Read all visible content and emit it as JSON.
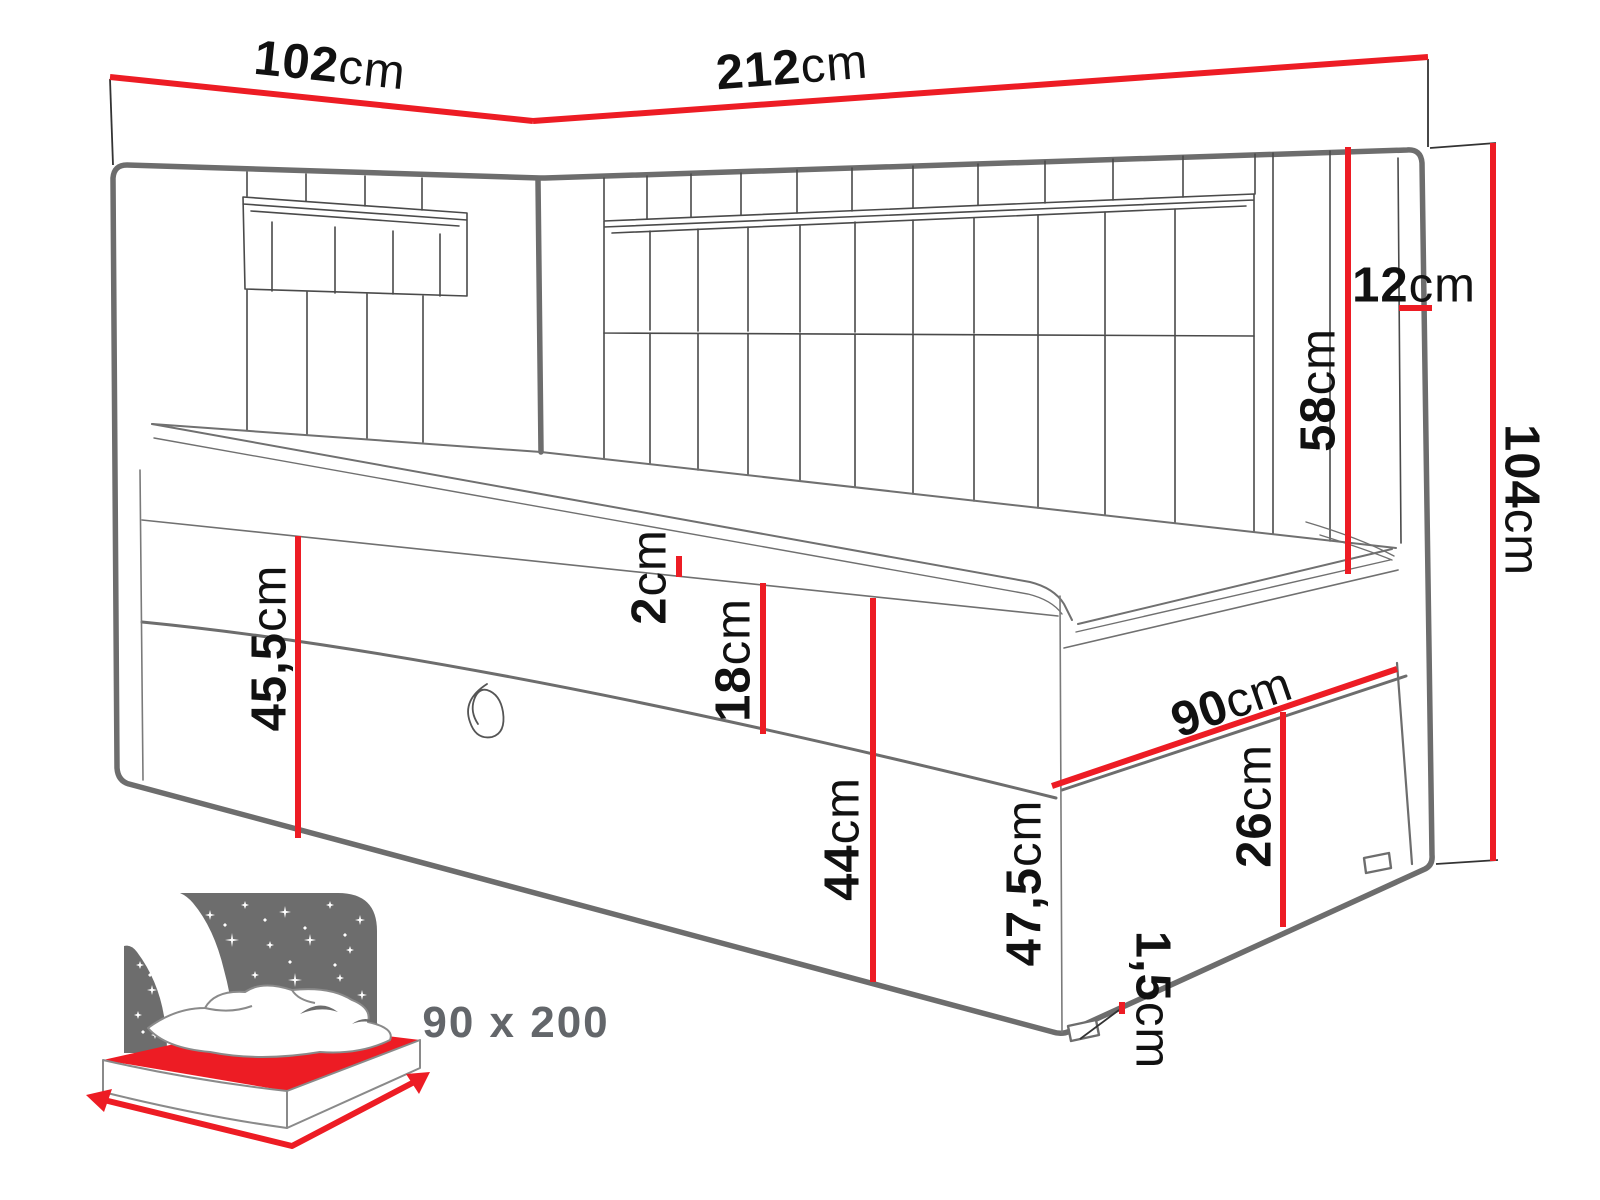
{
  "diagram": {
    "kind": "bed-dimension-drawing",
    "labels": {
      "head_width": {
        "value": "102",
        "unit": "cm"
      },
      "back_width": {
        "value": "212",
        "unit": "cm"
      },
      "total_height": {
        "value": "104",
        "unit": "cm"
      },
      "headboard_panel_height": {
        "value": "58",
        "unit": "cm"
      },
      "headboard_depth": {
        "value": "12",
        "unit": "cm"
      },
      "left_front_height": {
        "value": "45,5",
        "unit": "cm"
      },
      "topper_thickness": {
        "value": "2",
        "unit": "cm"
      },
      "upper_box_height": {
        "value": "18",
        "unit": "cm"
      },
      "front_panel_height": {
        "value": "44",
        "unit": "cm"
      },
      "side_depth": {
        "value": "90",
        "unit": "cm"
      },
      "side_drawer_height": {
        "value": "26",
        "unit": "cm"
      },
      "side_panel_height": {
        "value": "47,5",
        "unit": "cm"
      },
      "leg_height": {
        "value": "1,5",
        "unit": "cm"
      }
    },
    "inset": {
      "mattress_size": "90 x 200"
    },
    "colors": {
      "dimension_red": "#ed1c24",
      "outline_gray": "#6d6d6d",
      "seam_gray": "#4a4a4a",
      "label_text": "#111111",
      "inset_text": "#63666a"
    }
  }
}
